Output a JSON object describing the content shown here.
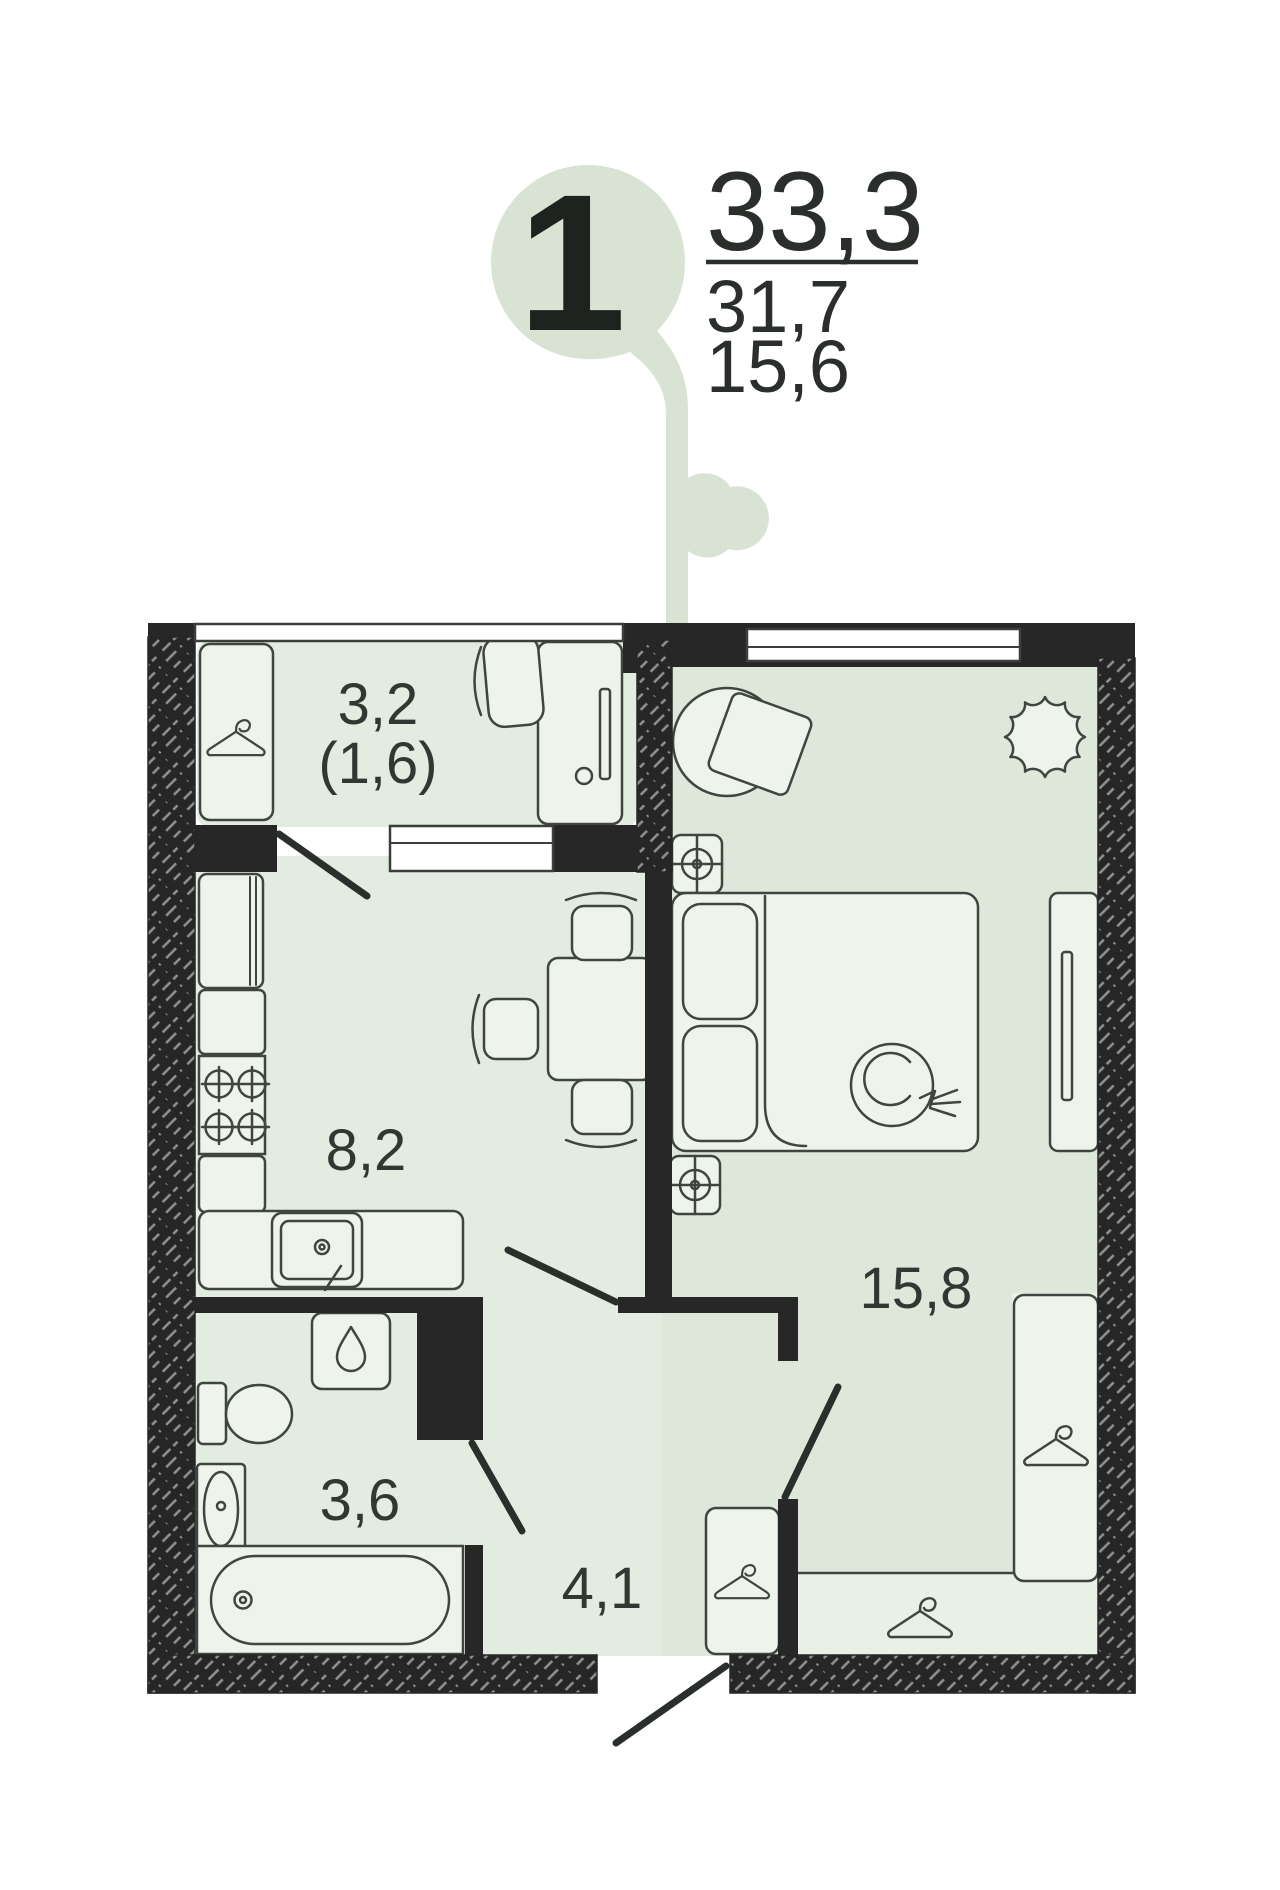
{
  "bubble": {
    "rooms_count": "1",
    "area_total": "33,3",
    "area_living": "31,7",
    "area_room": "15,6"
  },
  "room_labels": {
    "balcony": "3,2",
    "balcony_reduced": "(1,6)",
    "kitchen": "8,2",
    "bedroom": "15,8",
    "bathroom": "3,6",
    "hallway": "4,1"
  },
  "colors": {
    "bubble_green": "#d8e3d4",
    "floor": "#e3ece1",
    "floor_bedroom": "#dde8db",
    "wardrobe_zone": "#e9f0e6",
    "furniture": "#eef4ec",
    "wall": "#272727",
    "outline": "#3f453f",
    "text": "#2b2f2b"
  }
}
